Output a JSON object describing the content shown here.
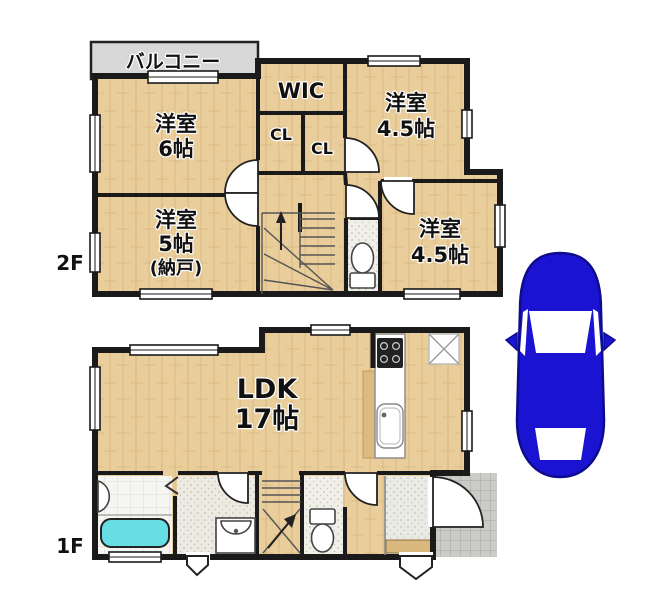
{
  "colors": {
    "wall": "#1a1a1a",
    "floor_wood": "#e9cd9a",
    "balcony": "#d8d8d8",
    "bathtub": "#67dde4",
    "car_body": "#1b13d2",
    "porch": "#cbcbc7",
    "bath_floor": "#f5f5f1",
    "wash_floor": "#eceae1",
    "toilet_floor": "#f1f0e8",
    "genkan_floor": "#ebebe5",
    "step_board": "#d9b87d",
    "stove": "#222222"
  },
  "floor2": {
    "label": "2F",
    "balcony_label": "バルコニー",
    "rooms": {
      "room6": {
        "name": "洋室",
        "size": "6帖"
      },
      "wic": {
        "name": "WIC"
      },
      "closet_a": {
        "name": "CL"
      },
      "closet_b": {
        "name": "CL"
      },
      "room45_upper": {
        "name": "洋室",
        "size": "4.5帖"
      },
      "room5": {
        "name": "洋室",
        "size": "5帖",
        "note": "(納戸)"
      },
      "room45_lower": {
        "name": "洋室",
        "size": "4.5帖"
      }
    }
  },
  "floor1": {
    "label": "1F",
    "rooms": {
      "ldk": {
        "name": "LDK",
        "size": "17帖"
      }
    }
  }
}
